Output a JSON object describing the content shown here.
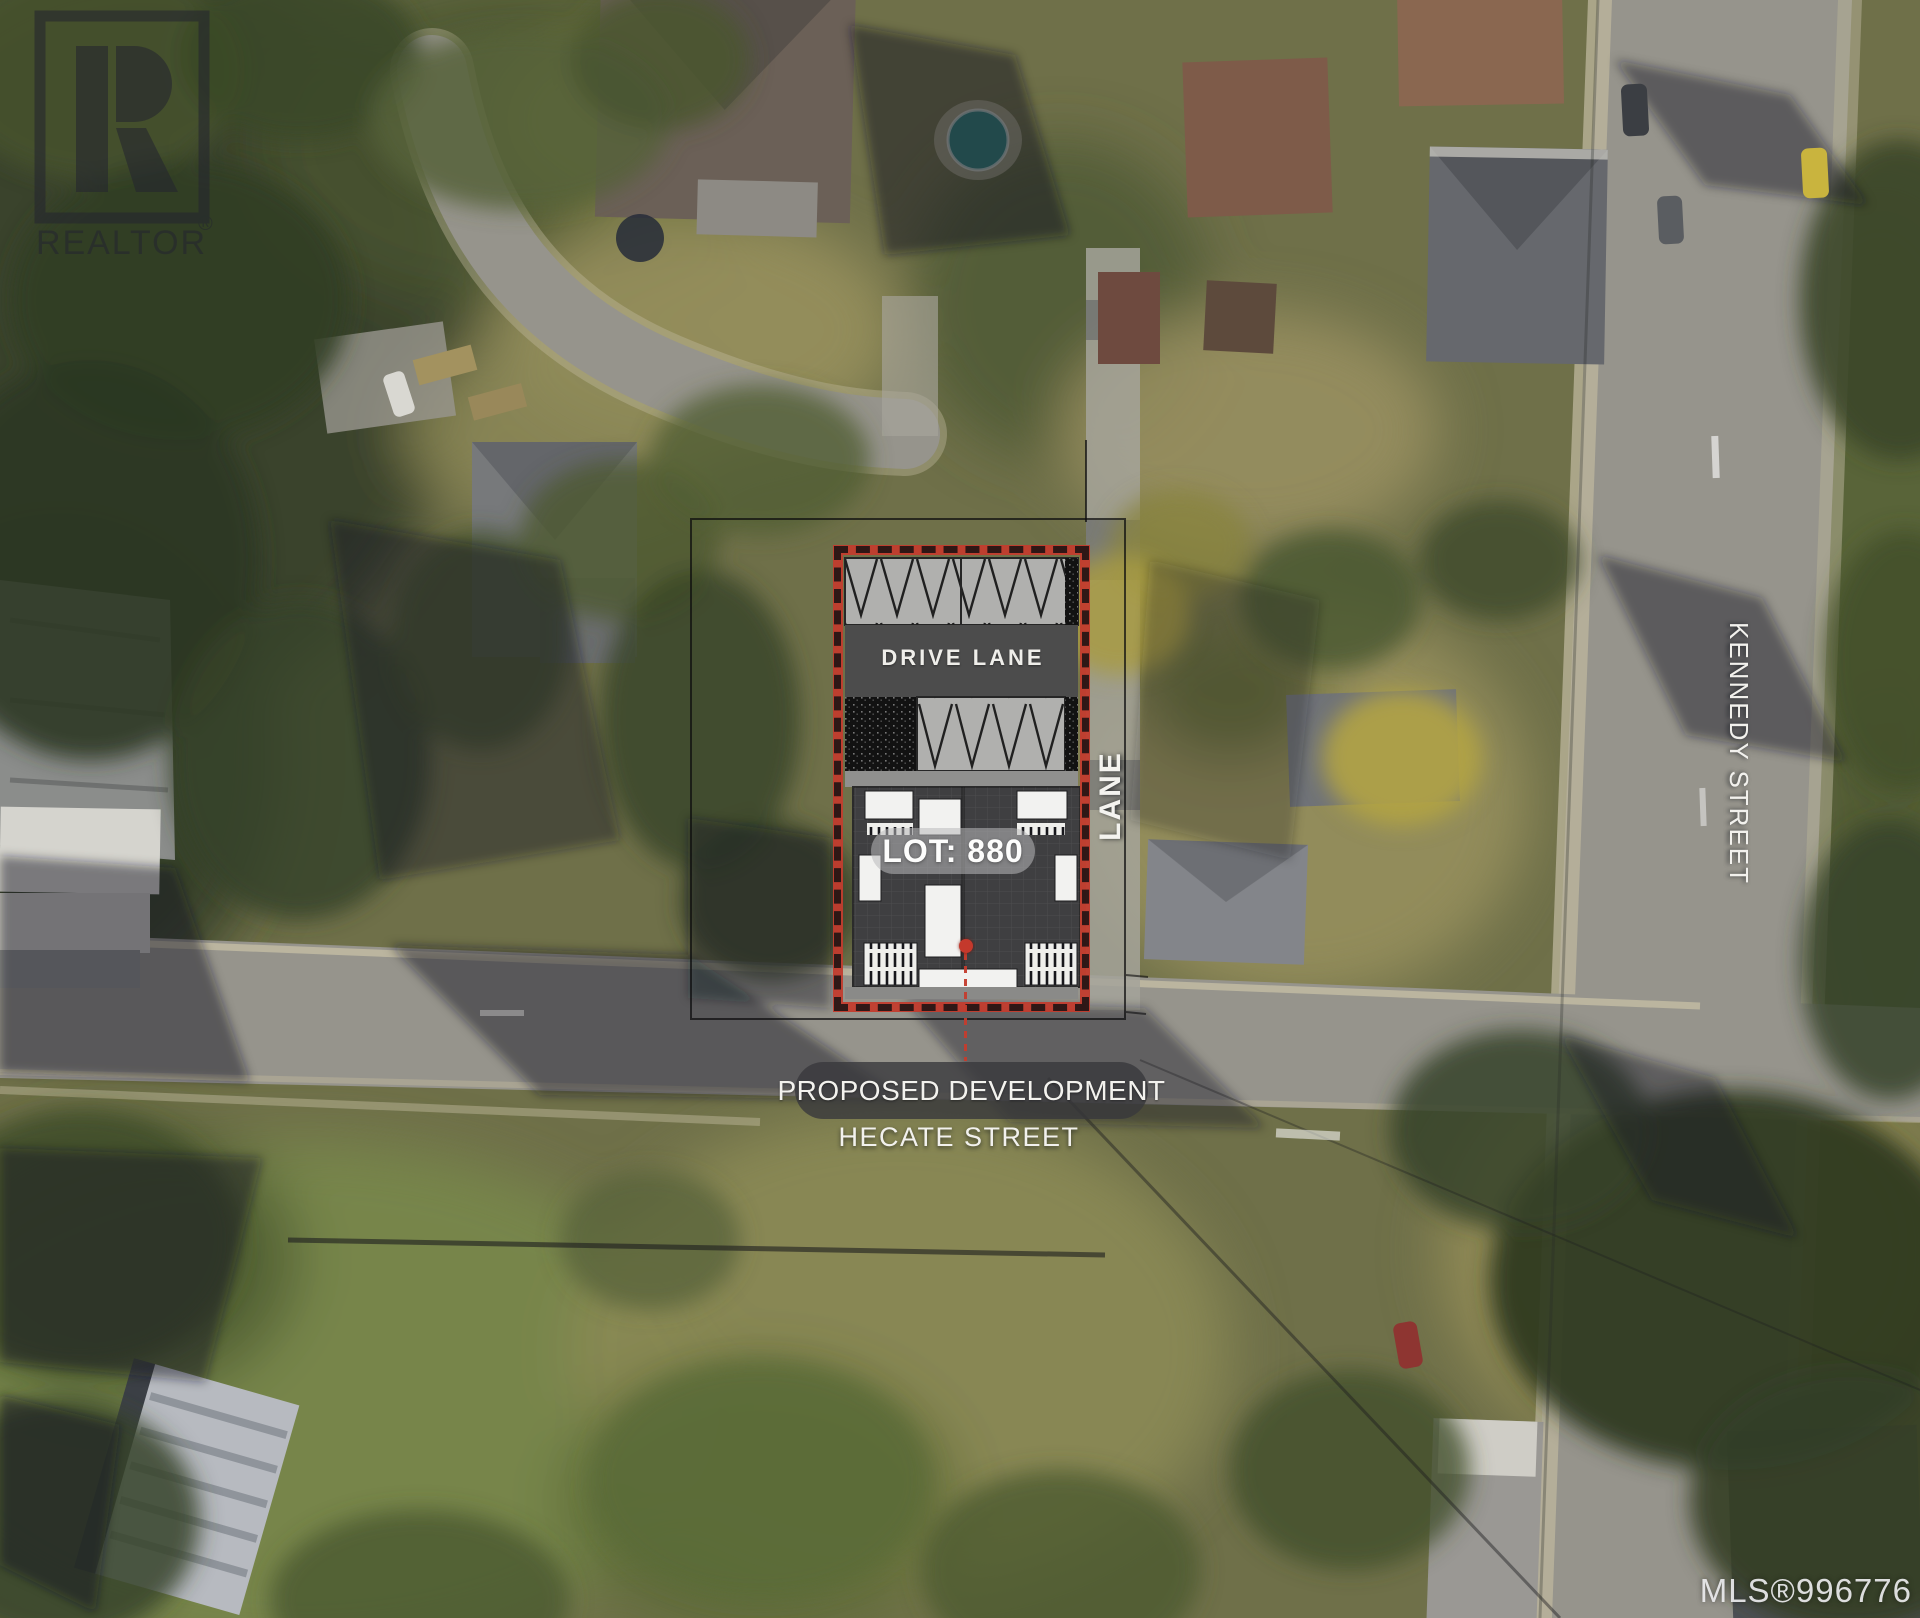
{
  "watermark": {
    "brand": "REALTOR",
    "registered": "®",
    "letter_icon": "realtor-r-icon"
  },
  "site_plan": {
    "drive_lane_label": "DRIVE LANE",
    "lot_label": "LOT: 880",
    "lane_label": "LANE"
  },
  "annotations": {
    "proposed_development": "PROPOSED DEVELOPMENT",
    "hecate_street": "HECATE STREET",
    "kennedy_street": "KENNEDY STREET"
  },
  "footer": {
    "mls_number": "MLS®996776"
  },
  "colors": {
    "boundary_red": "#c23c2e",
    "plan_parking_gray": "#b0b0ae",
    "plan_drive_lane_gray": "#4c4c4c",
    "plan_building_gray": "#3f3f41",
    "marker_red": "#c4392c",
    "watermark_dark": "#262830",
    "label_white": "#f2f1ed"
  }
}
